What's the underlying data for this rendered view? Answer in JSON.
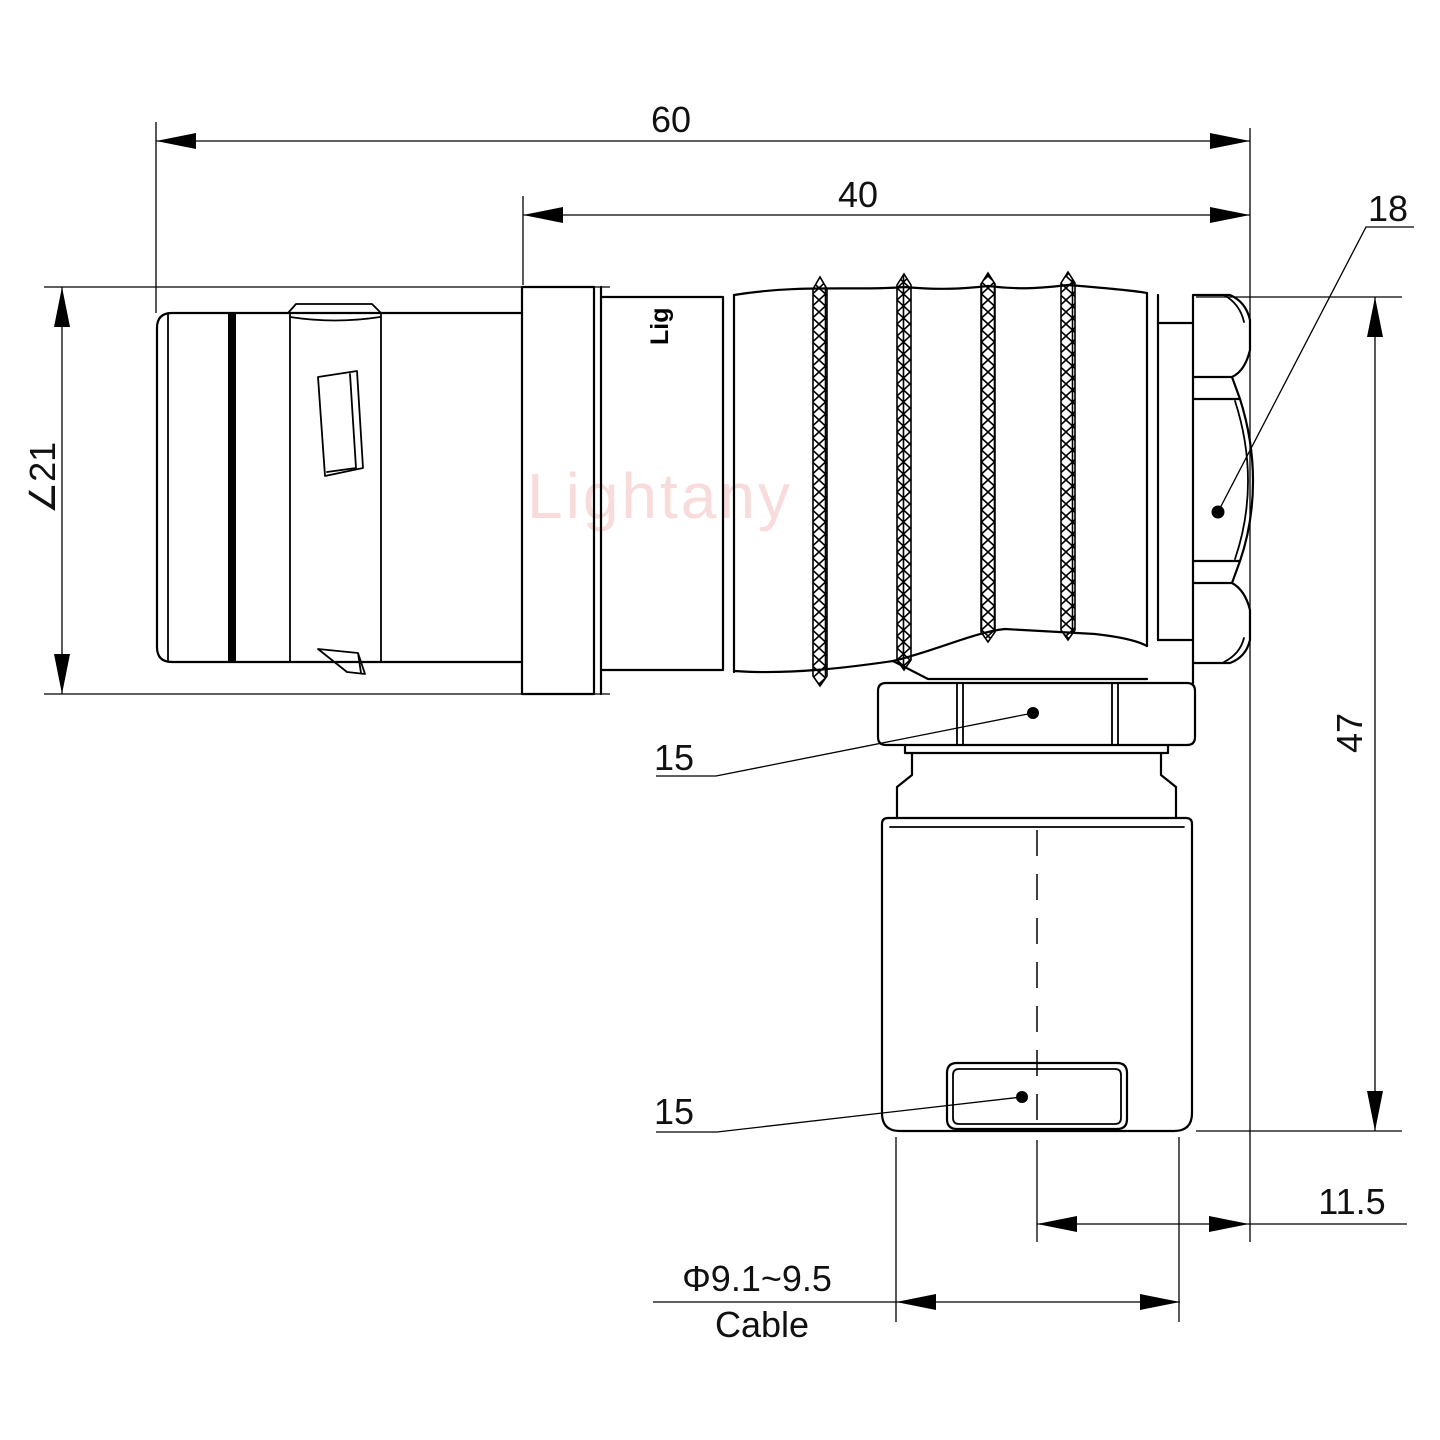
{
  "drawing": {
    "type": "connector-technical-drawing",
    "watermark": "Lightany",
    "barrel_logo": "Lig",
    "dimensions": {
      "overall_length": "60",
      "rear_length": "40",
      "hex_nut_size": "18",
      "plug_diameter": "∠21",
      "overall_height": "47",
      "elbow_nut_size": "15",
      "gland_nut_size": "15",
      "cable_offset": "11.5",
      "cable_diameter": "Φ9.1~9.5",
      "cable_label": "Cable"
    },
    "colors": {
      "line": "#000000",
      "watermark_pink": "#f8dcdc",
      "background": "#ffffff"
    }
  }
}
